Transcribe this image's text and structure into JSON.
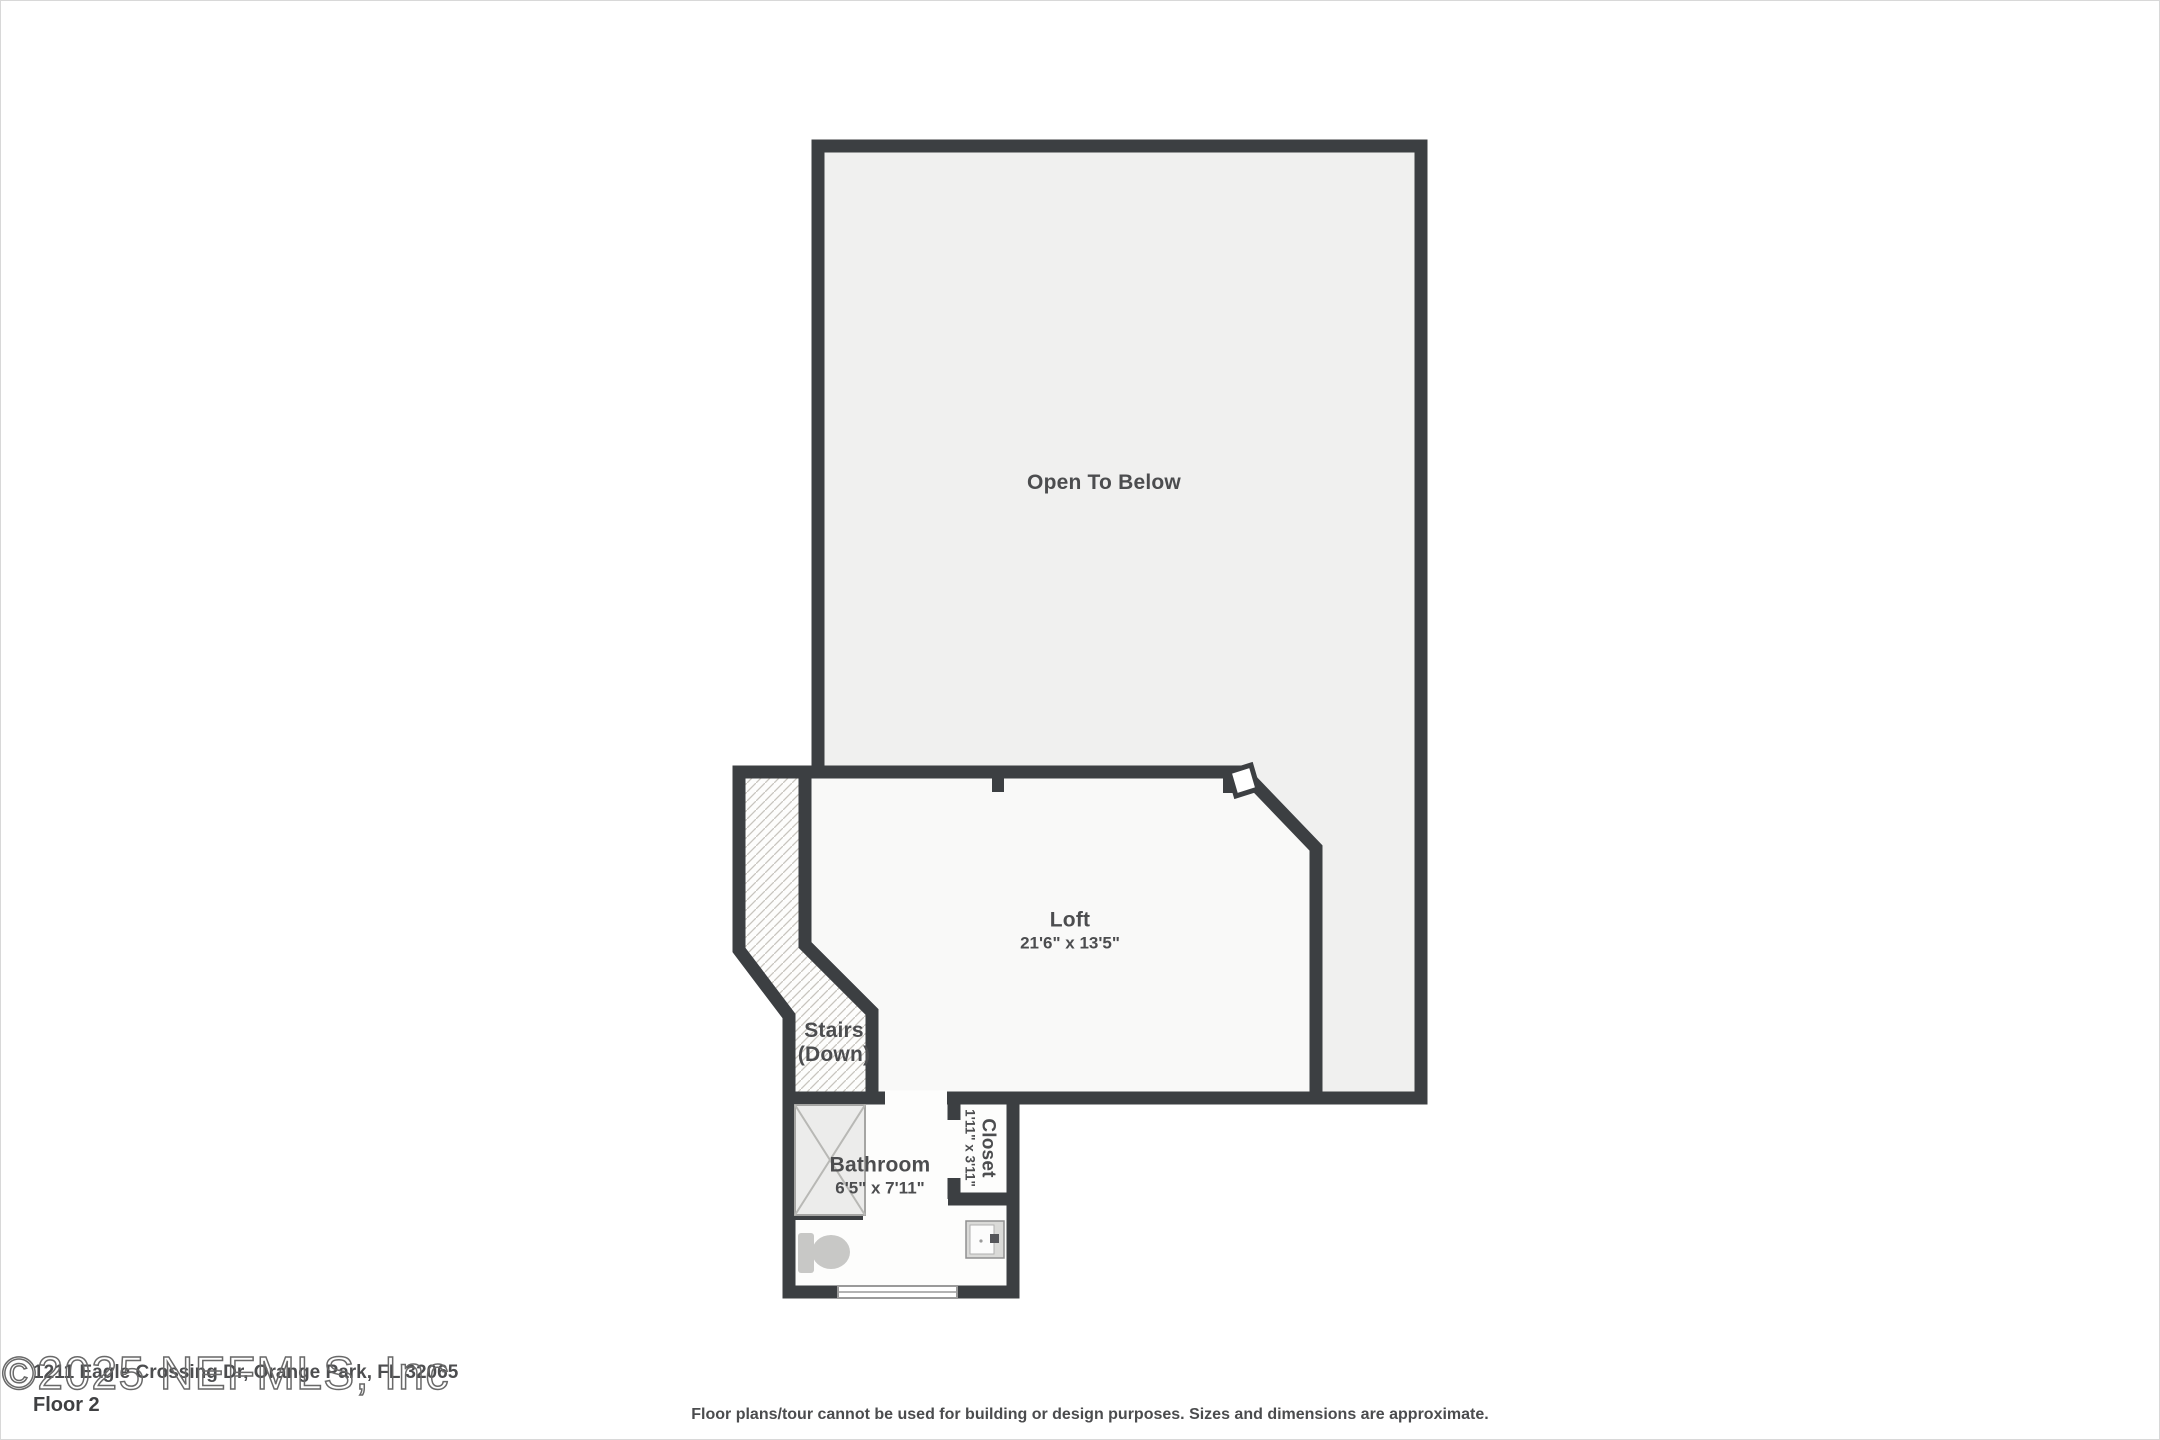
{
  "page": {
    "type": "floor-plan",
    "floor_label": "Floor 2",
    "address": "1211 Eagle Crossing Dr, Orange Park, FL 32065",
    "watermark": "©2025 NEFMLS, Inc",
    "disclaimer": "Floor plans/tour cannot be used for building or design purposes. Sizes and dimensions are approximate."
  },
  "rooms": {
    "open_to_below": {
      "label": "Open To Below"
    },
    "loft": {
      "label": "Loft",
      "dims": "21'6\" x 13'5\""
    },
    "stairs": {
      "line1": "Stairs",
      "line2": "(Down)"
    },
    "bathroom": {
      "label": "Bathroom",
      "dims": "6'5\" x 7'11\""
    },
    "closet": {
      "label": "Closet",
      "dims": "1'11\" x 3'11\""
    }
  },
  "fixtures": [
    "shower-icon",
    "toilet-icon",
    "sink-icon",
    "window-icon",
    "stairs-hatch",
    "door-swing-marker"
  ],
  "colors": {
    "wall": "#3c3f42",
    "open_to_below_fill": "#f0f0ef",
    "room_fill": "#f9f9f8",
    "fixture_gray": "#c8c8c6",
    "text": "#4c4d4f",
    "watermark_stroke": "#696969"
  }
}
